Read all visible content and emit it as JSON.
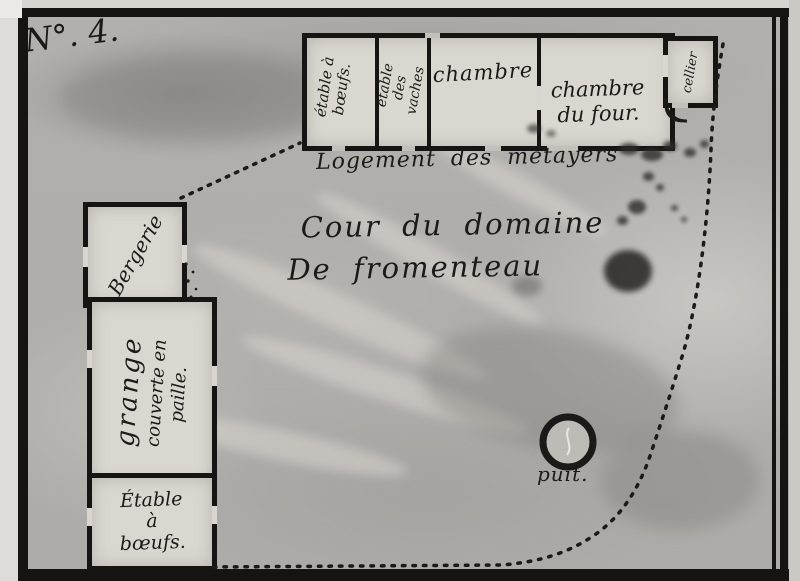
{
  "plate": {
    "number": "N°. 4."
  },
  "top_building": {
    "caption": "Logement des métayers",
    "rooms": [
      {
        "label": "étable à bœufs."
      },
      {
        "label": "étable des vaches"
      },
      {
        "label": "chambre"
      },
      {
        "label": "chambre du four.",
        "line1": "chambre",
        "line2": "du four."
      },
      {
        "label": "cellier"
      }
    ]
  },
  "courtyard": {
    "title_line1": "Cour du domaine",
    "title_line2": "De fromenteau"
  },
  "left_buildings": {
    "bergerie": "Bergerie",
    "grange": {
      "line1": "grange",
      "line2": "couverte en",
      "line3": "paille."
    },
    "etable": {
      "line1": "Étable",
      "line2": "à",
      "line3": "bœufs."
    }
  },
  "well": {
    "label": "puit."
  },
  "colors": {
    "ink": "#1b1a18",
    "paper": "#b2b0ac",
    "paper_light": "#d9d7d0"
  }
}
